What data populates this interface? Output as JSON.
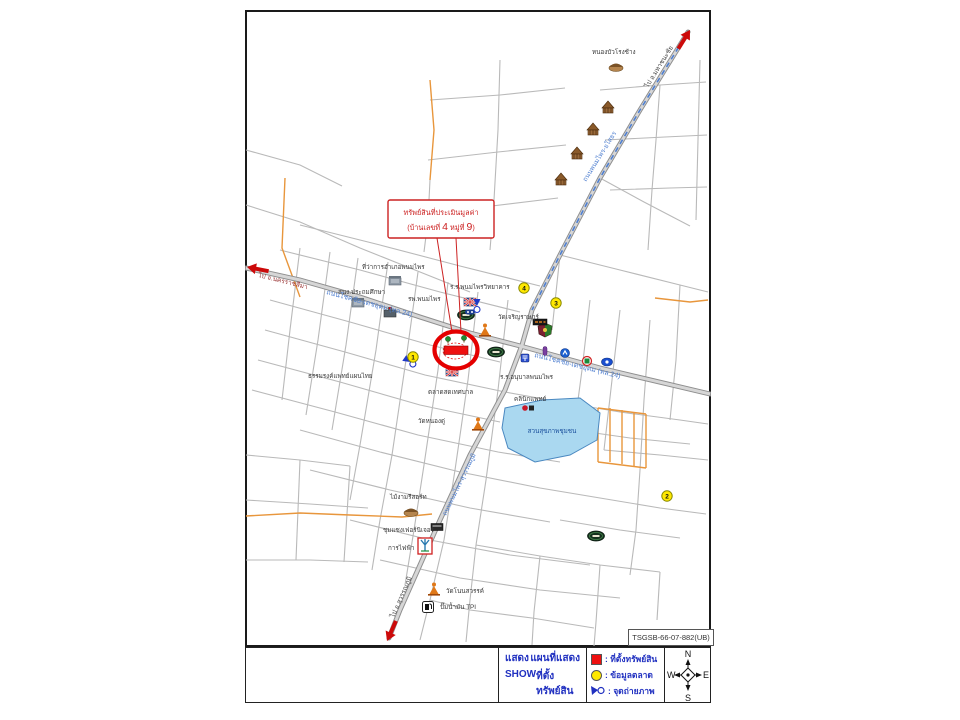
{
  "colors": {
    "legend_text_blue": "#2030c0",
    "property_red": "#ee1010",
    "market_yellow": "#ffe800",
    "road_gray": "#b9b9b9",
    "highway_gray": "#8f8f8f",
    "minor_road_orange": "#e8963c",
    "pond_blue": "#aad8f0",
    "annotation_red": "#cc2222",
    "road_name_blue": "#4f7fd0"
  },
  "ref_box": {
    "label": "TSGSB-66-07-882(UB)"
  },
  "callout": {
    "line1": "ทรัพย์สินที่ประเมินมูลค่า",
    "l2_pre": "(บ้านเลขที่ ",
    "house_no": "4",
    "l2_mid": " หมู่ที่ ",
    "moo_no": "9",
    "l2_post": ")"
  },
  "footer": {
    "cell_show": {
      "word1": "แสดง",
      "word2": "แผนที่แสดง",
      "word3": "SHOW",
      "word4": "ที่ตั้งทรัพย์สิน"
    },
    "legend": [
      {
        "symbol": "red-square",
        "label": ": ที่ตั้งทรัพย์สิน"
      },
      {
        "symbol": "yellow-circle",
        "label": ": ข้อมูลตลาด"
      },
      {
        "symbol": "photo-point",
        "label": ": จุดถ่ายภาพ"
      }
    ],
    "compass": {
      "n": "N",
      "s": "S",
      "e": "E",
      "w": "W"
    }
  },
  "map": {
    "roads": [
      "246,205 300,222 360,248 420,272 470,292",
      "280,250 360,270 440,292 520,312",
      "300,225 380,245 460,266 540,286",
      "270,300 350,322 430,345 500,362",
      "265,330 345,352 425,375 505,392 560,402",
      "258,360 340,382 420,405 500,422",
      "252,390 335,412 418,435 498,452 560,462",
      "300,430 380,452 460,472 540,488",
      "310,470 390,490 470,508 550,522",
      "350,520 430,540 510,555 590,565",
      "380,560 460,578 540,590 620,598",
      "300,248 290,330 282,400",
      "330,252 318,340 306,415",
      "358,258 346,345 332,430",
      "388,262 376,350 360,445 350,500",
      "418,272 406,360 392,455 380,520 372,570",
      "448,282 438,370 424,465 414,530 405,585",
      "478,292 468,380 455,470 444,540",
      "508,300 498,390 486,480 476,545",
      "430,180 428,220 424,252",
      "500,60 498,130 494,200 490,250",
      "430,100 500,95 565,88",
      "428,160 498,152 566,145",
      "424,215 492,206 558,198",
      "600,90 660,85 706,82",
      "605,140 665,137 707,135",
      "610,190 670,188 707,187",
      "660,85 656,140 652,190 648,250",
      "700,60 698,140 696,220",
      "600,178 644,202 690,226",
      "560,255 620,270 680,285 708,292",
      "560,255 552,330",
      "590,300 582,370 574,430",
      "620,310 612,380 604,450",
      "650,320 644,400 640,470",
      "680,285 676,360 670,420",
      "560,402 620,412 680,420 708,424",
      "574,430 630,438 690,444",
      "604,450 660,455 708,460",
      "540,488 600,498 660,508 706,514",
      "560,520 620,530 680,538",
      "476,545 540,556 600,565 660,572",
      "444,540 430,600 420,640",
      "476,545 470,600 466,642",
      "540,556 534,612 532,645",
      "600,565 596,622 594,646",
      "660,572 657,620",
      "430,600 470,610 532,618 594,628",
      "640,470 636,530 630,575",
      "246,455 300,460 350,466",
      "246,500 310,504 368,508",
      "246,560 310,560 368,562",
      "300,460 296,560",
      "350,466 344,562",
      "246,150 300,165 342,186"
    ],
    "orange_roads": [
      "285,178 282,248 300,297",
      "430,80 434,130 430,180",
      "655,298 690,302 708,300",
      "246,516 300,513 350,515 402,517 432,514",
      "598,408 598,462",
      "610,408 610,462",
      "622,410 622,464",
      "634,412 634,466",
      "646,414 646,468",
      "598,408 646,414",
      "598,462 646,468"
    ],
    "highways": [
      "246,268 300,280 360,297 420,317 470,333 524,347 600,368 710,394",
      "688,32 640,110 600,178 560,255 532,310 522,345 505,390 470,455 440,520 400,610 389,638"
    ],
    "highway_blue_dash": "688,32 640,110 600,178 560,255 532,310",
    "pond": {
      "points": "505,408 542,400 580,398 600,413 597,440 570,455 535,462 508,448 502,428"
    },
    "road_labels": [
      {
        "text": "ถนนโชคชัย-เดชอุดม (ทล.24)",
        "x": 326,
        "y": 294,
        "rot": 15,
        "color": "#4f7fd0",
        "size": 7
      },
      {
        "text": "ถนนโชคชัย-เดชอุดม (ทล.24)",
        "x": 534,
        "y": 357,
        "rot": 14,
        "color": "#4f7fd0",
        "size": 7
      },
      {
        "text": "ถนนพนมไพร-ยโสธร",
        "x": 586,
        "y": 182,
        "rot": -58,
        "color": "#4f7fd0",
        "size": 6.5
      },
      {
        "text": "ถนนพนมไพร-สุวรรณภูมิ",
        "x": 446,
        "y": 516,
        "rot": -64,
        "color": "#4f7fd0",
        "size": 6.5
      },
      {
        "text": "ไป จ.นครราชสีมา",
        "x": 258,
        "y": 277,
        "rot": 14,
        "color": "#993333",
        "size": 6.5
      },
      {
        "text": "ไป อ.มหาชนะชัย",
        "x": 648,
        "y": 88,
        "rot": -58,
        "color": "#444444",
        "size": 6.5
      },
      {
        "text": "ไป อ.สุวรรณภูมิ",
        "x": 394,
        "y": 618,
        "rot": -66,
        "color": "#444444",
        "size": 6.5
      }
    ],
    "labels": [
      {
        "text": "หนองบัวโรงช้าง",
        "x": 592,
        "y": 54
      },
      {
        "text": "ที่ว่าการอำเภอพนมไพร",
        "x": 362,
        "y": 269
      },
      {
        "text": "สนง.ประถมศึกษา",
        "x": 338,
        "y": 294
      },
      {
        "text": "รพ.พนมไพร",
        "x": 408,
        "y": 301
      },
      {
        "text": "ร.ร.พนมไพรวิทยาคาร",
        "x": 450,
        "y": 289
      },
      {
        "text": "วัดเจริญราษฎร์",
        "x": 498,
        "y": 319
      },
      {
        "text": "ร.ร.อนุบาลพนมไพร",
        "x": 500,
        "y": 379
      },
      {
        "text": "ธรรมรงค์แพทย์แผนไทย",
        "x": 308,
        "y": 378
      },
      {
        "text": "ตลาดสดเทศบาล",
        "x": 428,
        "y": 394
      },
      {
        "text": "คลินิกแพทย์",
        "x": 514,
        "y": 401
      },
      {
        "text": "วัดหนองดู่",
        "x": 418,
        "y": 423
      },
      {
        "text": "ไม้งามรีสอร์ท",
        "x": 390,
        "y": 499
      },
      {
        "text": "ชุมแซงเฟอร์นิเจอร์",
        "x": 383,
        "y": 532
      },
      {
        "text": "การไฟฟ้า",
        "x": 388,
        "y": 550
      },
      {
        "text": "วัดโนนสวรรค์",
        "x": 446,
        "y": 593
      },
      {
        "text": "ปั๊มน้ำมัน TPI",
        "x": 440,
        "y": 609
      },
      {
        "text": "สวนสุขภาพชุมชน",
        "x": 552,
        "y": 433,
        "color": "#1a4f9c",
        "anchor": "middle"
      }
    ],
    "icons": [
      {
        "type": "temple",
        "x": 608,
        "y": 107
      },
      {
        "type": "temple",
        "x": 593,
        "y": 129
      },
      {
        "type": "temple",
        "x": 577,
        "y": 153
      },
      {
        "type": "temple",
        "x": 561,
        "y": 179
      },
      {
        "type": "hut",
        "x": 616,
        "y": 66
      },
      {
        "type": "hut",
        "x": 411,
        "y": 511
      },
      {
        "type": "building",
        "x": 395,
        "y": 281
      },
      {
        "type": "building",
        "x": 358,
        "y": 303
      },
      {
        "type": "hospital",
        "x": 390,
        "y": 313
      },
      {
        "type": "school-flag",
        "x": 470,
        "y": 302
      },
      {
        "type": "school-flag",
        "x": 452,
        "y": 372
      },
      {
        "type": "bank",
        "x": 466,
        "y": 315
      },
      {
        "type": "bank",
        "x": 496,
        "y": 352
      },
      {
        "type": "bank",
        "x": 596,
        "y": 536
      },
      {
        "type": "crest",
        "x": 545,
        "y": 330
      },
      {
        "type": "buddha",
        "x": 485,
        "y": 330
      },
      {
        "type": "buddha",
        "x": 478,
        "y": 424
      },
      {
        "type": "buddha",
        "x": 434,
        "y": 589
      },
      {
        "type": "sign-dark",
        "x": 540,
        "y": 322
      },
      {
        "type": "post",
        "x": 525,
        "y": 358
      },
      {
        "type": "ptt",
        "x": 565,
        "y": 353
      },
      {
        "type": "k-ring",
        "x": 587,
        "y": 361
      },
      {
        "type": "star-oval",
        "x": 607,
        "y": 362
      },
      {
        "type": "pill-purple",
        "x": 545,
        "y": 351
      },
      {
        "type": "pill-navy",
        "x": 470,
        "y": 312
      },
      {
        "type": "clinic",
        "x": 528,
        "y": 408
      },
      {
        "type": "pump",
        "x": 428,
        "y": 607
      },
      {
        "type": "pylon",
        "x": 425,
        "y": 546
      },
      {
        "type": "furniture",
        "x": 437,
        "y": 527
      },
      {
        "type": "photo-point",
        "x": 410,
        "y": 362,
        "rot": 35
      },
      {
        "type": "photo-point",
        "x": 477,
        "y": 306,
        "rot": 90
      }
    ],
    "numbered_points": [
      {
        "n": "1",
        "x": 413,
        "y": 357
      },
      {
        "n": "2",
        "x": 667,
        "y": 496
      },
      {
        "n": "3",
        "x": 556,
        "y": 303
      },
      {
        "n": "4",
        "x": 524,
        "y": 288
      }
    ],
    "arrows": [
      {
        "x": 247,
        "y": 267,
        "rot": 11
      },
      {
        "x": 690,
        "y": 30,
        "rot": 122
      },
      {
        "x": 387,
        "y": 641,
        "rot": -66
      }
    ],
    "property_marker": {
      "cx": 456,
      "cy": 350
    }
  }
}
